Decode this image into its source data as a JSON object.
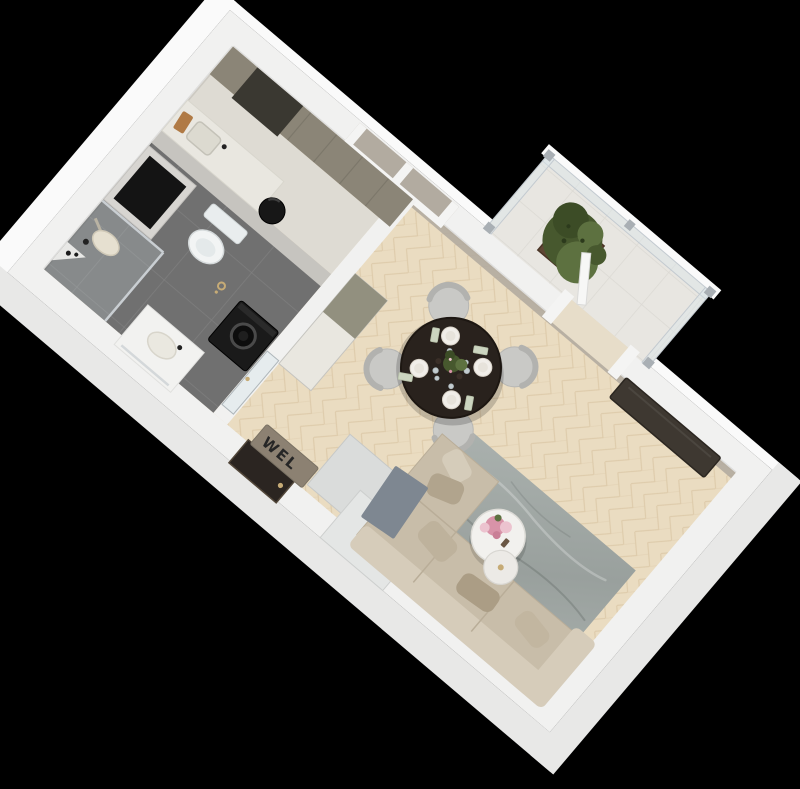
{
  "image": {
    "type": "3d-floor-plan-render",
    "view": "isometric-top-down",
    "subject": "studio-apartment"
  },
  "doormat": {
    "text": "WEL"
  },
  "dining": {
    "chairs": 4,
    "place_settings": 4
  },
  "scene": {
    "rooms": [
      "bathroom",
      "kitchen-niche",
      "entry-hall",
      "living-dining-room",
      "balcony"
    ],
    "furniture": [
      "shower",
      "toilet",
      "vanity-sink",
      "washing-machine",
      "kitchen-cabinets",
      "kitchen-counter",
      "trash-bin",
      "wardrobe-blocks",
      "dining-table",
      "dining-chairs",
      "rug",
      "nesting-coffee-tables",
      "sofa",
      "tv-panel",
      "balcony-plant",
      "welcome-mat",
      "entry-door"
    ]
  },
  "palette": {
    "background": "#000000",
    "wall": "#f1f1f0",
    "wall_face_bright": "#fafafa",
    "wall_face_shade": "#e8e8e7",
    "partition_wall": "#c6c4bf",
    "white_surface": "#f4f4f3",
    "wall_taupe": "#b2aba0",
    "wood_floor": "#eadcc1",
    "wood_line": "#d9c5a4",
    "niche_floor": "#dedbd3",
    "bath_tile": "#707070",
    "bath_tile_line": "#7e7e7e",
    "balcony_floor": "#e8e6e1",
    "balcony_tile_line": "#dbd9d3",
    "kitchen_cabinet": "#8b8577",
    "kitchen_dark_unit": "#3a3831",
    "counter_top": "#e9e7e0",
    "granite": "#92907f",
    "appliance_black": "#1a1a1a",
    "shaft_dark": "#141414",
    "toilet_white": "#f2f4f4",
    "dining_table": "#29221d",
    "chair": "#c9c9c6",
    "chair_back": "#b2b2af",
    "rug_light": "#aab1ae",
    "rug_dark": "#99a09d",
    "sofa": "#c8bda9",
    "sofa_back": "#d6ccba",
    "sofa_cushion": "#b1a48d",
    "throw_gray": "#7e8791",
    "coffee_table": "#f2f1ee",
    "plant_green": "#47582e",
    "plant_green_light": "#5d7140",
    "planter_brown": "#5f4634",
    "glass": "#dce7ec",
    "railing_post": "#a9afb4",
    "tv_screen": "#3e3831",
    "entry_door": "#2b2521",
    "mat": "#8c8172",
    "mat_text": "#262626",
    "gold": "#c6ab76",
    "flower_pink": "#d893a8",
    "flower_pink_light": "#ecc3cf"
  }
}
